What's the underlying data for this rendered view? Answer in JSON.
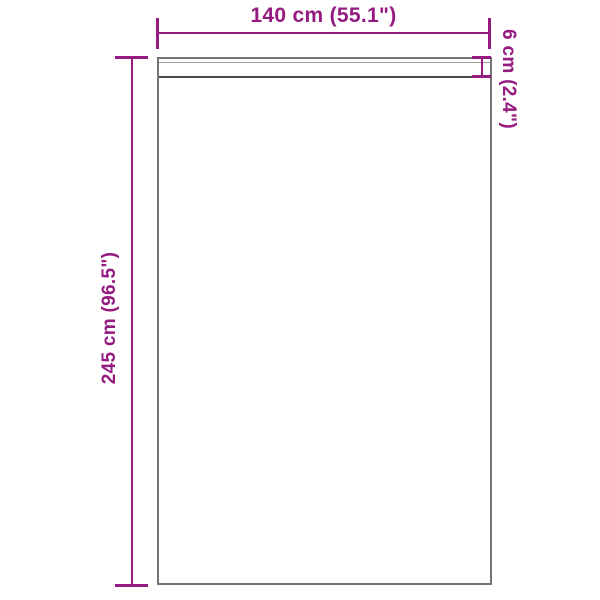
{
  "diagram": {
    "width_dimension": {
      "label": "140 cm (55.1\")"
    },
    "height_dimension": {
      "label": "245 cm (96.5\")"
    },
    "header_dimension": {
      "label": "6 cm (2.4\")"
    },
    "colors": {
      "dimension": "#951b81",
      "outline": "#757575",
      "seam": "#4a4a4a",
      "fold": "#9d9d9d",
      "background": "#ffffff"
    }
  }
}
